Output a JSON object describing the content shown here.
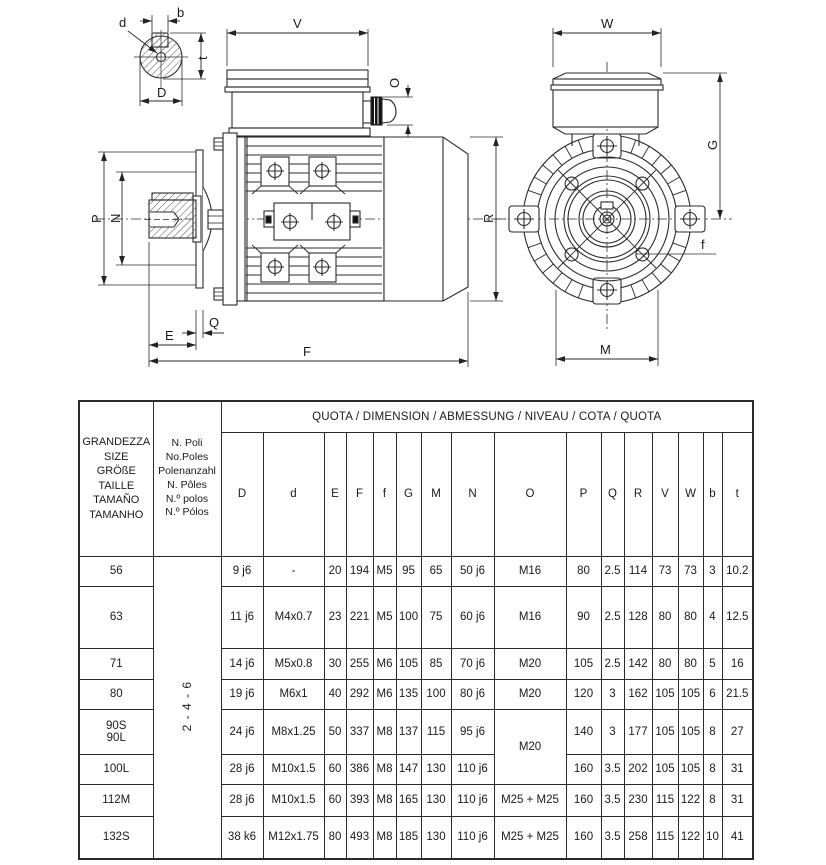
{
  "drawing": {
    "section_labels": {
      "b": "b",
      "d": "d",
      "t": "t",
      "D": "D"
    },
    "side_labels": {
      "V": "V",
      "O": "O",
      "P": "P",
      "N": "N",
      "E": "E",
      "Q": "Q",
      "F": "F",
      "R": "R"
    },
    "front_labels": {
      "W": "W",
      "G": "G",
      "f": "f",
      "M": "M"
    }
  },
  "table": {
    "size_lines": [
      "GRANDEZZA",
      "SIZE",
      "GRÖßE",
      "TAILLE",
      "TAMAÑO",
      "TAMANHO"
    ],
    "poles_lines": [
      "N. Poli",
      "No.Poles",
      "Polenanzahl",
      "N. Pôles",
      "N.º polos",
      "N.º Pólos"
    ],
    "quota_heading": "QUOTA / DIMENSION / ABMESSUNG / NIVEAU / COTA / QUOTA",
    "dim_columns": [
      "D",
      "d",
      "E",
      "F",
      "f",
      "G",
      "M",
      "N",
      "O",
      "P",
      "Q",
      "R",
      "V",
      "W",
      "b",
      "t"
    ],
    "poles_value": "2 - 4 - 6",
    "rows": [
      {
        "size": "56",
        "cells": [
          "9 j6",
          "-",
          "20",
          "194",
          "M5",
          "95",
          "65",
          "50 j6",
          "M16",
          "80",
          "2.5",
          "114",
          "73",
          "73",
          "3",
          "10.2"
        ]
      },
      {
        "size": "63",
        "cells": [
          "11 j6",
          "M4x0.7",
          "23",
          "221",
          "M5",
          "100",
          "75",
          "60 j6",
          "M16",
          "90",
          "2.5",
          "128",
          "80",
          "80",
          "4",
          "12.5"
        ]
      },
      {
        "size": "71",
        "cells": [
          "14 j6",
          "M5x0.8",
          "30",
          "255",
          "M6",
          "105",
          "85",
          "70 j6",
          "M20",
          "105",
          "2.5",
          "142",
          "80",
          "80",
          "5",
          "16"
        ]
      },
      {
        "size": "80",
        "cells": [
          "19 j6",
          "M6x1",
          "40",
          "292",
          "M6",
          "135",
          "100",
          "80 j6",
          "M20",
          "120",
          "3",
          "162",
          "105",
          "105",
          "6",
          "21.5"
        ]
      },
      {
        "size": "90S",
        "size2": "90L",
        "cells": [
          "24 j6",
          "M8x1.25",
          "50",
          "337",
          "M8",
          "137",
          "115",
          "95 j6",
          "M20",
          "140",
          "3",
          "177",
          "105",
          "105",
          "8",
          "27"
        ]
      },
      {
        "size": "100L",
        "cells": [
          "28 j6",
          "M10x1.5",
          "60",
          "386",
          "M8",
          "147",
          "130",
          "110 j6",
          "",
          "160",
          "3.5",
          "202",
          "105",
          "105",
          "8",
          "31"
        ]
      },
      {
        "size": "112M",
        "cells": [
          "28 j6",
          "M10x1.5",
          "60",
          "393",
          "M8",
          "165",
          "130",
          "110 j6",
          "M25 + M25",
          "160",
          "3.5",
          "230",
          "115",
          "122",
          "8",
          "31"
        ]
      },
      {
        "size": "132S",
        "cells": [
          "38 k6",
          "M12x1.75",
          "80",
          "493",
          "M8",
          "185",
          "130",
          "110 j6",
          "M25 + M25",
          "160",
          "3.5",
          "258",
          "115",
          "122",
          "10",
          "41"
        ]
      }
    ]
  }
}
